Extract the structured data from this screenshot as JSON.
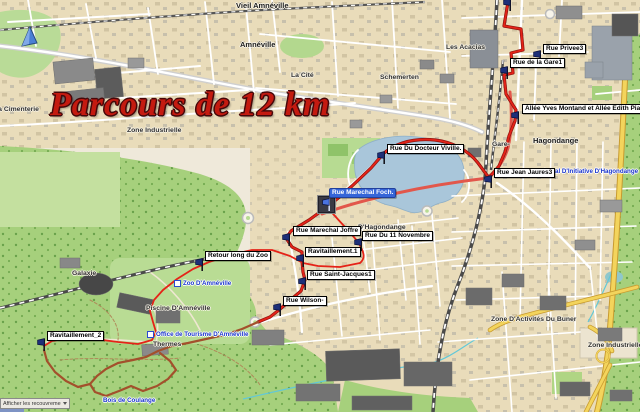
{
  "title": {
    "text": "Parcours de 12 km"
  },
  "colors": {
    "route_city": "#e52318",
    "route_forest": "#a3502c",
    "primary_road": "#e2574b",
    "highway_yellow": "#f3d45c",
    "water": "#a9c6da",
    "forest": "#a6d07c",
    "waypoint_flag": "#1d2f78",
    "selected_label_bg": "#3565d8",
    "title_red": "#c41a10"
  },
  "waypoints": [
    {
      "label": "Rue Privee3",
      "lx": 543,
      "ly": 44,
      "fx": 533,
      "fy": 50,
      "selected": false
    },
    {
      "label": "Rue de la Gare1",
      "lx": 510,
      "ly": 58,
      "fx": 500,
      "fy": 66,
      "selected": false
    },
    {
      "label": "Allée Yves Montand et Allée Edith Piaf3",
      "lx": 522,
      "ly": 104,
      "fx": 511,
      "fy": 111,
      "selected": false
    },
    {
      "label": "Rue Du Docteur Viville.",
      "lx": 387,
      "ly": 144,
      "fx": 377,
      "fy": 151,
      "selected": false
    },
    {
      "label": "Rue Jean Jaures3",
      "lx": 494,
      "ly": 168,
      "fx": 484,
      "fy": 175,
      "selected": false
    },
    {
      "label": "Rue Marechal Foch.",
      "lx": 329,
      "ly": 188,
      "fx": 318,
      "fy": 196,
      "selected": true
    },
    {
      "label": "Rue Marechal Joffre",
      "lx": 293,
      "ly": 226,
      "fx": 282,
      "fy": 233,
      "selected": false
    },
    {
      "label": "Rue Du 11 Novembre",
      "lx": 362,
      "ly": 231,
      "fx": 354,
      "fy": 238,
      "selected": false
    },
    {
      "label": "Ravitaillement.1",
      "lx": 305,
      "ly": 247,
      "fx": 296,
      "fy": 254,
      "selected": false
    },
    {
      "label": "Rue Saint-Jacques1",
      "lx": 307,
      "ly": 270,
      "fx": 298,
      "fy": 277,
      "selected": false
    },
    {
      "label": "Rue Wilson-",
      "lx": 283,
      "ly": 296,
      "fx": 273,
      "fy": 303,
      "selected": false
    },
    {
      "label": "Retour long du Zoo",
      "lx": 205,
      "ly": 251,
      "fx": 195,
      "fy": 258,
      "selected": false
    },
    {
      "label": "Ravitaillement_2",
      "lx": 47,
      "ly": 331,
      "fx": 37,
      "fy": 338,
      "selected": false
    }
  ],
  "extra_flags": [
    {
      "fx": 503,
      "fy": -2
    }
  ],
  "place_labels": [
    {
      "text": "Vieil Amnéville",
      "x": 236,
      "y": 1,
      "kind": "city"
    },
    {
      "text": "Amnéville",
      "x": 240,
      "y": 40,
      "kind": "city"
    },
    {
      "text": "La Cité",
      "x": 291,
      "y": 72,
      "kind": "suburb"
    },
    {
      "text": "Les Acacias",
      "x": 446,
      "y": 44,
      "kind": "suburb"
    },
    {
      "text": "Schemerten",
      "x": 380,
      "y": 74,
      "kind": "suburb"
    },
    {
      "text": "La Cimenterie",
      "x": -6,
      "y": 106,
      "kind": "suburb"
    },
    {
      "text": "Zone Industrielle",
      "x": 127,
      "y": 127,
      "kind": "suburb"
    },
    {
      "text": "Gare-",
      "x": 492,
      "y": 141,
      "kind": "suburb"
    },
    {
      "text": "Hagondange",
      "x": 533,
      "y": 136,
      "kind": "city"
    },
    {
      "text": "D'Hagondange",
      "x": 358,
      "y": 224,
      "kind": "suburb"
    },
    {
      "text": "Galaxie",
      "x": 72,
      "y": 270,
      "kind": "suburb"
    },
    {
      "text": "Piscine D'Amnéville",
      "x": 146,
      "y": 305,
      "kind": "suburb"
    },
    {
      "text": "Thermes",
      "x": 153,
      "y": 341,
      "kind": "suburb"
    },
    {
      "text": "Zone D'Activités Du Buner",
      "x": 491,
      "y": 316,
      "kind": "suburb"
    },
    {
      "text": "Zone Industrielle",
      "x": 588,
      "y": 342,
      "kind": "suburb"
    }
  ],
  "poi_labels": [
    {
      "text": "Zoo D'Amnéville",
      "x": 174,
      "y": 280,
      "icon": true
    },
    {
      "text": "Office de Tourisme D'Amnéville",
      "x": 147,
      "y": 331,
      "icon": true
    },
    {
      "text": "Local D'Initiative D'Hagondange",
      "x": 544,
      "y": 168,
      "icon": false
    },
    {
      "text": "Bois de Coulange",
      "x": 103,
      "y": 397,
      "icon": false
    }
  ],
  "controls": {
    "overlay_dropdown_label": "Afficher les recouvrements"
  }
}
